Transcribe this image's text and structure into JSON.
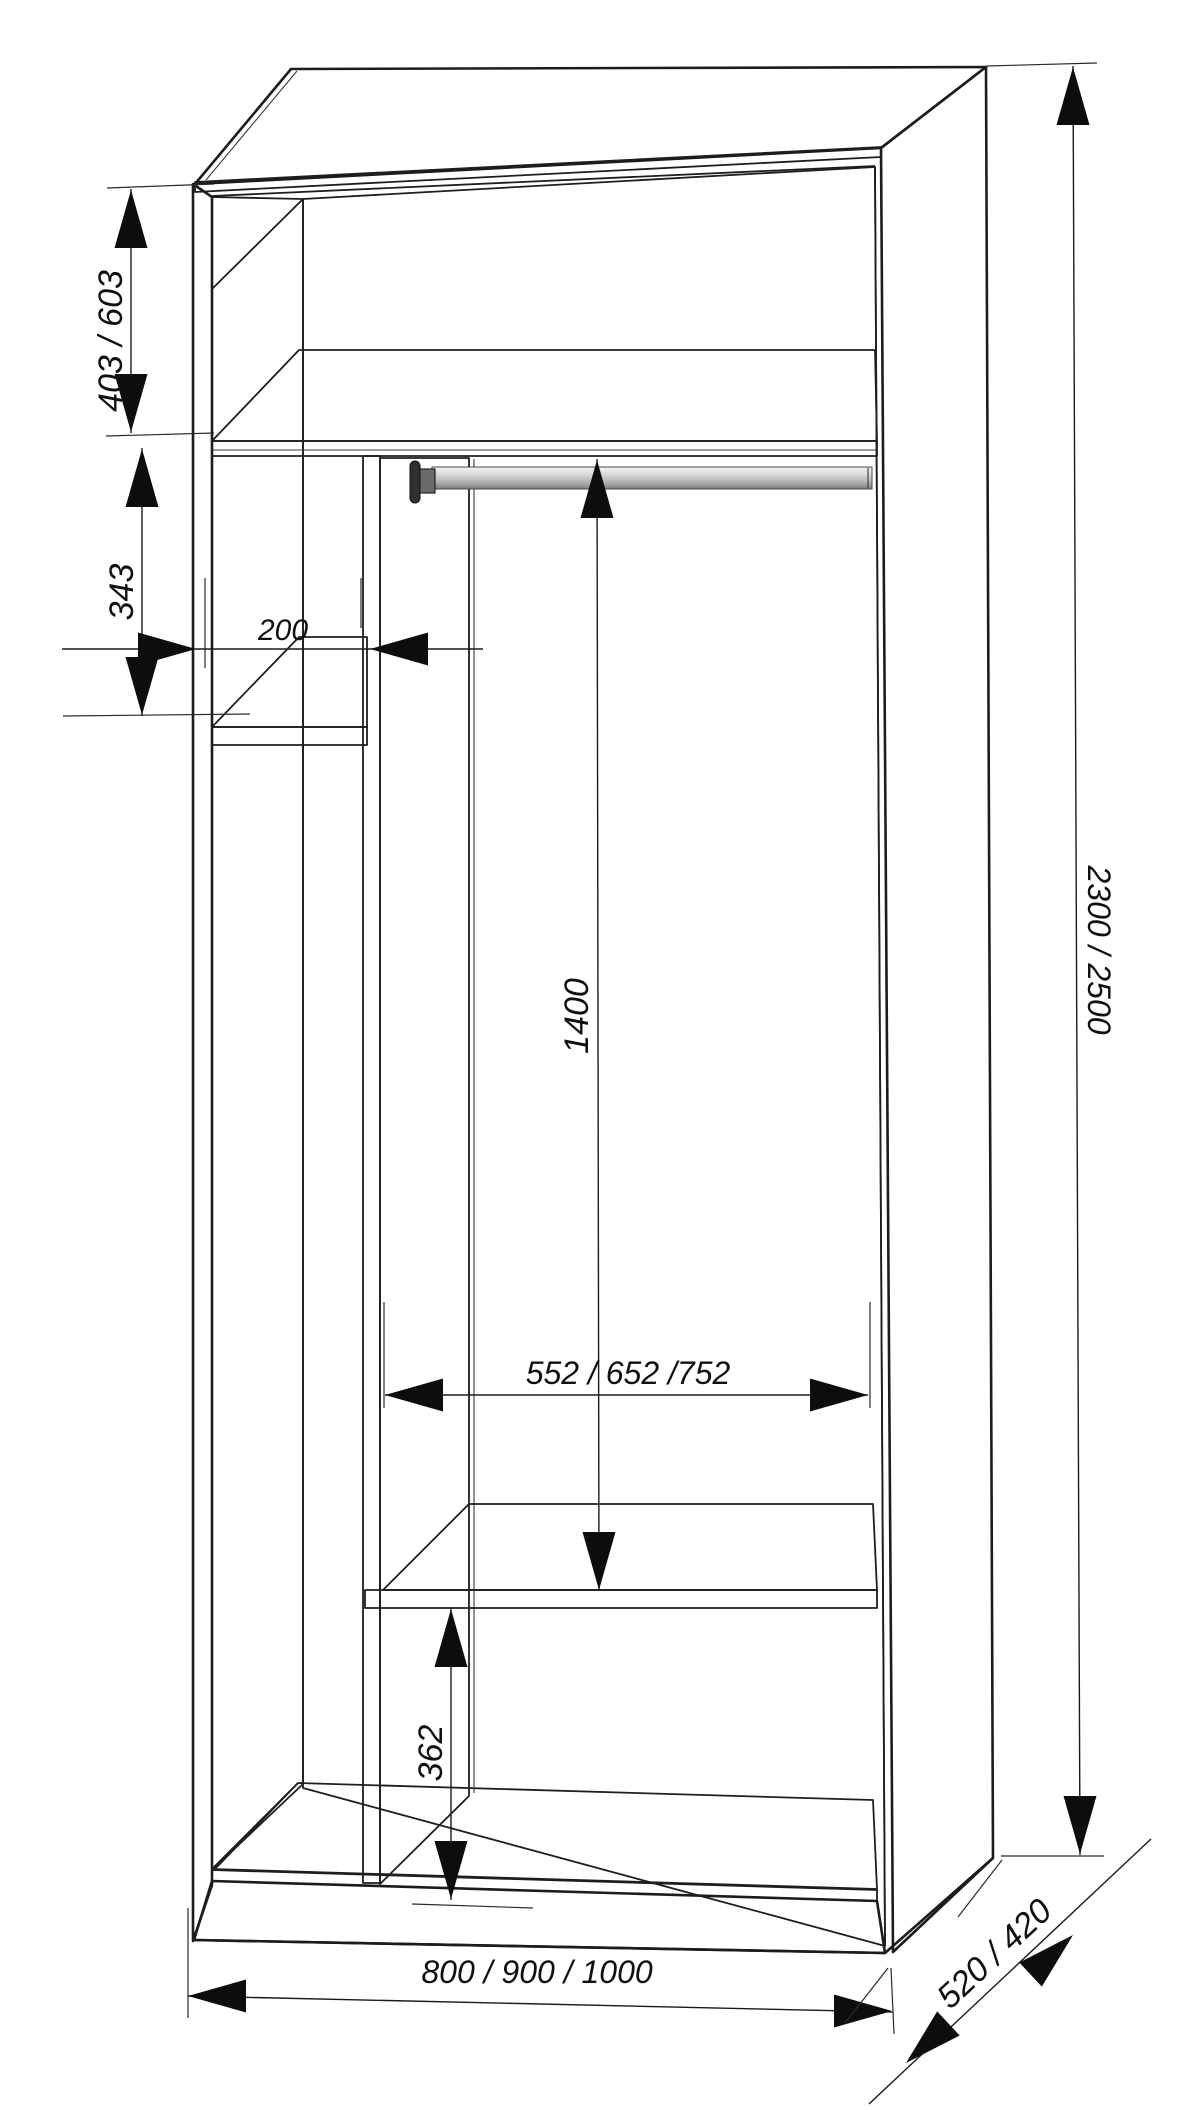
{
  "title": "Wardrobe interior dimensions drawing",
  "dimensions": {
    "upper_shelf_height": "403 / 603",
    "left_shelf_gap": "343",
    "side_column_width": "200",
    "hanging_space_height": "1400",
    "main_compartment_width": "552 / 652 /752",
    "bottom_compartment_height": "362",
    "overall_height": "2300 / 2500",
    "overall_width": "800 / 900 / 1000",
    "overall_depth": "520 / 420"
  },
  "colors": {
    "top_face": "#e9e6d9",
    "side_panel": "#d6d3c6",
    "panel_interior": "#d0cdc0",
    "divider_face": "#d2cfc2",
    "shelf_top": "#edeade",
    "edge_band": "#e8e5d8",
    "back_wall": "#e3e3e5",
    "plinth": "#cfccbf",
    "outline": "#1c1c1c",
    "dimension_ink": "#0d0d0d"
  }
}
